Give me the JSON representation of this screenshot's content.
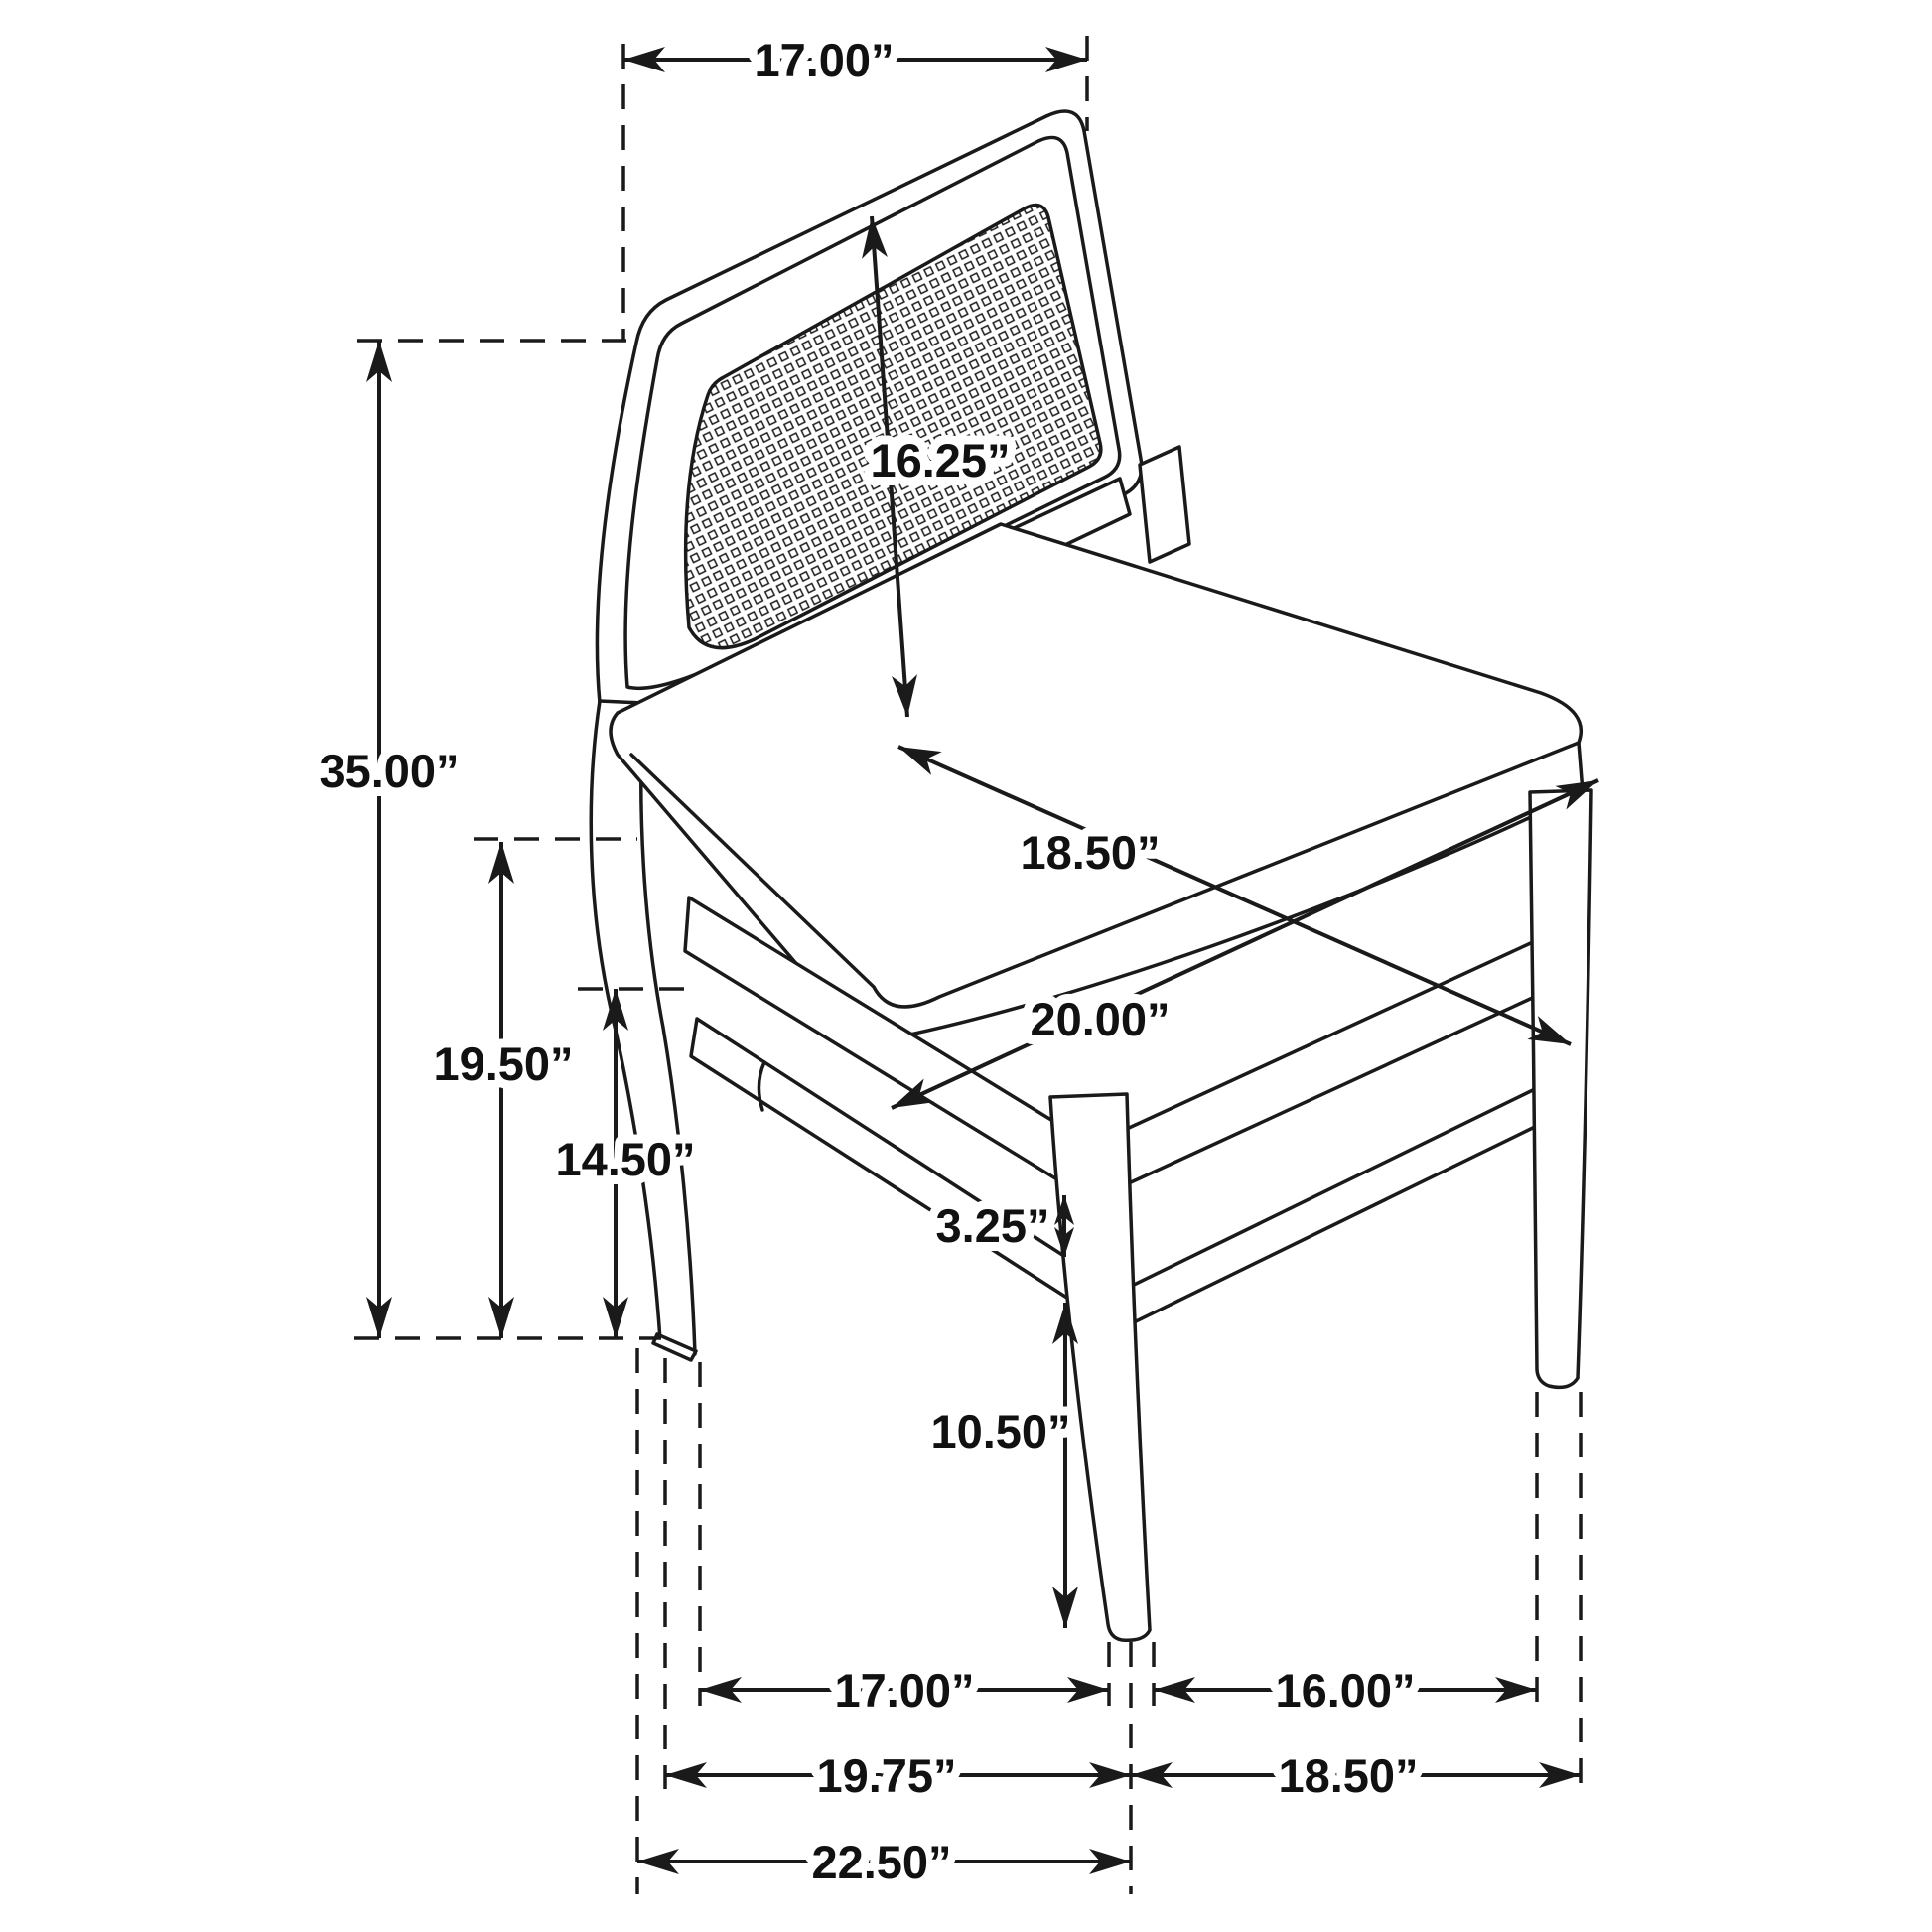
{
  "diagram": {
    "type": "furniture-dimension-diagram",
    "subject": "dining side chair with cane back panel and upholstered seat, three-quarter view line drawing",
    "background_color": "#ffffff",
    "line_color": "#1a1a1a",
    "units": "inches",
    "dimensions": {
      "back_width": {
        "label": "17.00”",
        "value": 17.0,
        "description": "width across top of chair back"
      },
      "back_panel_height": {
        "label": "16.25”",
        "value": 16.25,
        "description": "height of back panel from seat to top rail"
      },
      "overall_height": {
        "label": "35.00”",
        "value": 35.0,
        "description": "overall chair height from floor to top of back"
      },
      "seat_height": {
        "label": "19.50”",
        "value": 19.5,
        "description": "floor to top of seat"
      },
      "apron_height": {
        "label": "14.50”",
        "value": 14.5,
        "description": "floor to bottom of seat rail"
      },
      "seat_depth": {
        "label": "18.50”",
        "value": 18.5,
        "description": "seat depth front to back"
      },
      "seat_width": {
        "label": "20.00”",
        "value": 20.0,
        "description": "seat width side to side"
      },
      "stretcher_gap": {
        "label": "3.25”",
        "value": 3.25,
        "description": "gap between seat rail and side stretcher"
      },
      "front_leg_height": {
        "label": "10.50”",
        "value": 10.5,
        "description": "stretcher to floor along front leg"
      },
      "leg_span_side": {
        "label": "17.00”",
        "value": 17.0,
        "description": "floor span, rear leg to front leg (side)"
      },
      "leg_span_front": {
        "label": "16.00”",
        "value": 16.0,
        "description": "floor span between front legs"
      },
      "depth_to_center": {
        "label": "19.75”",
        "value": 19.75,
        "description": "floor depth, rear leg to front leg centerline"
      },
      "width_at_floor": {
        "label": "18.50”",
        "value": 18.5,
        "description": "floor span, front leg centerline to right leg"
      },
      "overall_depth": {
        "label": "22.50”",
        "value": 22.5,
        "description": "overall depth at floor"
      }
    }
  }
}
